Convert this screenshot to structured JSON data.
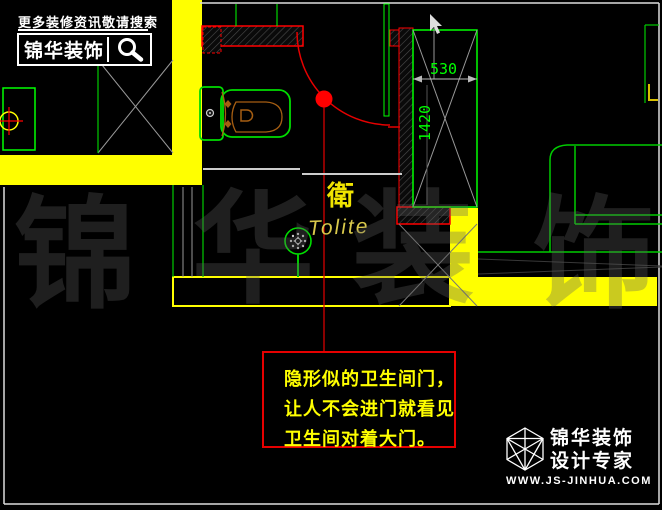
{
  "header": {
    "tagline": "更多装修资讯敬请搜索",
    "brand": "锦华装饰",
    "search_icon": "magnifier-icon"
  },
  "drawing": {
    "room_label": "衛",
    "room_label_en": "Tolite",
    "dimensions": {
      "door_width": "530",
      "door_height": "1420"
    },
    "fixture_icons": [
      "toilet-icon",
      "shower-icon",
      "sofa-icon",
      "door-swing-icon",
      "floor-drain-icon"
    ]
  },
  "annotation": {
    "lines": [
      "隐形似的卫生间门，",
      "让人不会进门就看见",
      "卫生间对着大门。"
    ]
  },
  "watermark": {
    "chars": [
      "锦",
      "华",
      "装",
      "饰"
    ]
  },
  "footer": {
    "brand_line1": "锦华装饰",
    "brand_line2": "设计专家",
    "url": "WWW.JS-JINHUA.COM",
    "logo_icon": "cube-logo-icon"
  },
  "colors": {
    "background": "#000000",
    "cad_green": "#00ff00",
    "highlight_yellow": "#ffff00",
    "annotation_red": "#e60000",
    "wall_hatch_red": "#ff0000",
    "fixture_brown": "#a65e12",
    "dim_text_green": "#00ff00",
    "watermark_gray": "rgba(95,95,95,0.33)"
  }
}
